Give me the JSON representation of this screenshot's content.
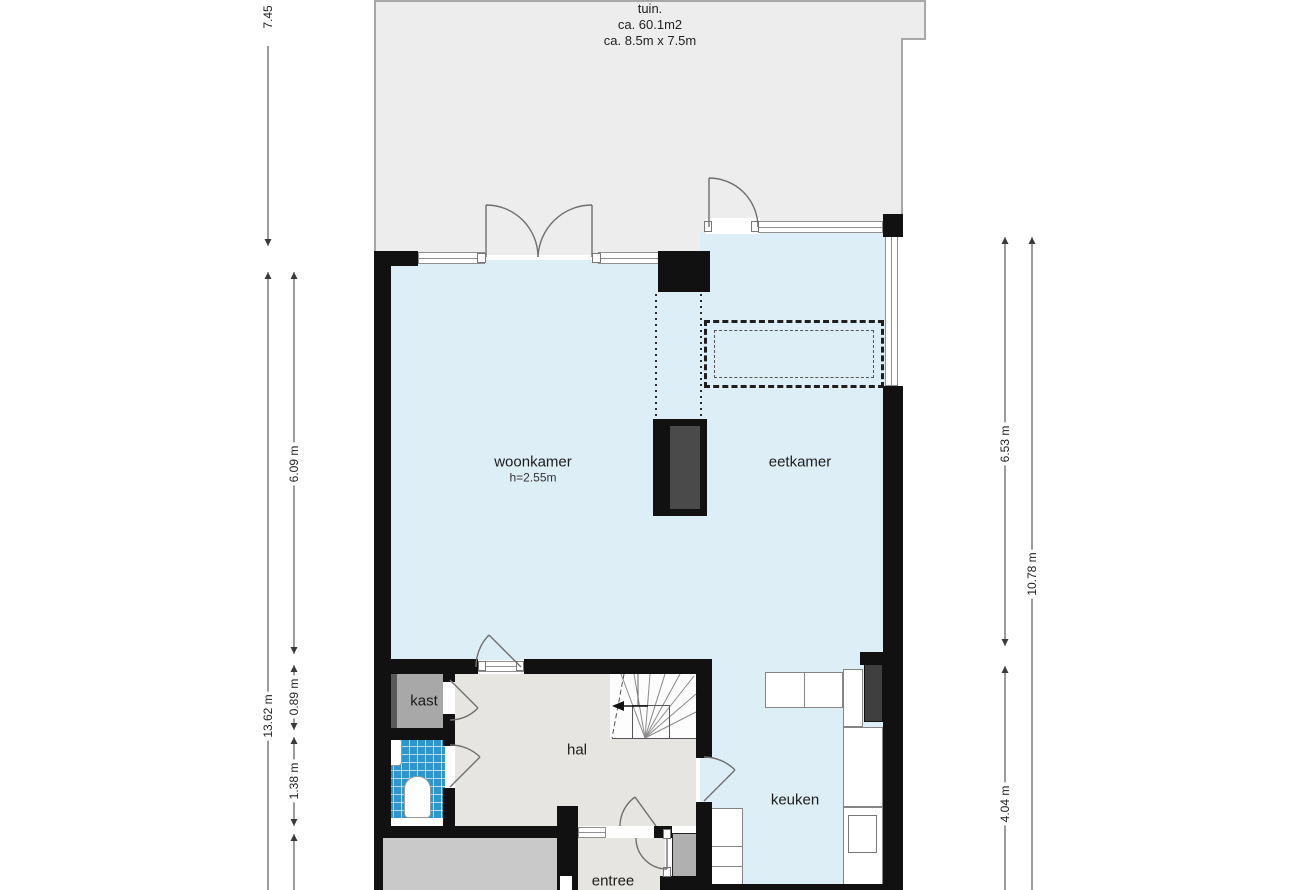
{
  "garden": {
    "name": "tuin.",
    "area": "ca. 60.1m2",
    "size": "ca. 8.5m x 7.5m"
  },
  "rooms": {
    "woonkamer": {
      "label": "woonkamer",
      "ceiling": "h=2.55m"
    },
    "eetkamer": {
      "label": "eetkamer"
    },
    "keuken": {
      "label": "keuken"
    },
    "hal": {
      "label": "hal"
    },
    "kast": {
      "label": "kast"
    },
    "entree": {
      "label": "entree"
    }
  },
  "dimensions": {
    "garden_depth": "7.45",
    "total_left": "13.62 m",
    "woonkamer_length": "6.09 m",
    "kast_depth": "0.89 m",
    "toilet_depth": "1.38 m",
    "eetkamer_length": "6.53 m",
    "total_right": "10.78 m",
    "keuken_length": "4.04 m"
  },
  "colors": {
    "wall": "#111111",
    "floor_blue": "#ddeef7",
    "garden_gray": "#ededed",
    "hal_gray": "#e7e5e1",
    "kast_gray": "#a8a8a8",
    "storage_gray": "#c9c9c9",
    "tile_blue": "#2e96cf",
    "chimney_inner": "#4a4a4a"
  }
}
